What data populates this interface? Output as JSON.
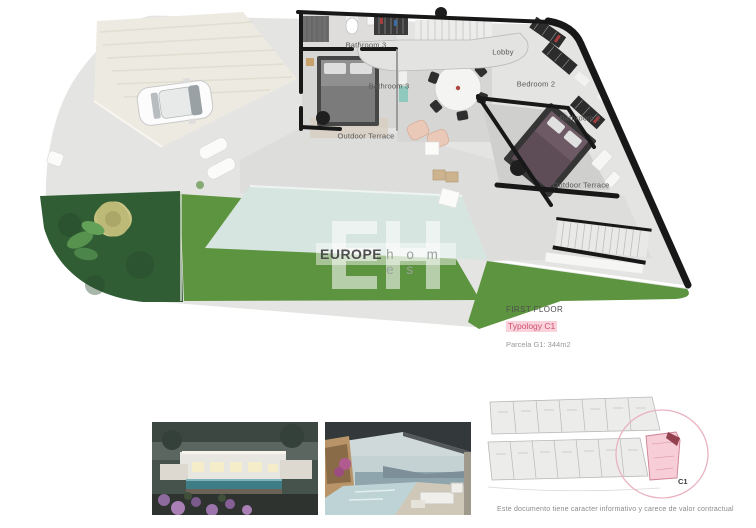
{
  "floorplan": {
    "labels": {
      "bathroom3_top": "Bathroom 3",
      "bathroom3_side": "Bathroom 3",
      "lobby": "Lobby",
      "bedroom2": "Bedroom 2",
      "bathroom2": "Bathroom 2",
      "outdoor_terrace_left": "Outdoor Terrace",
      "outdoor_terrace_right": "Outdoor Terrace"
    }
  },
  "logo": {
    "monogram": "EH",
    "primary": "EUROPE",
    "secondary": "h o m e s"
  },
  "title_block": {
    "floor": "FIRST FLOOR",
    "typology": "Typology C1",
    "parcel": "Parcela G1: 344m2"
  },
  "site_plan": {
    "unit_label": "C1"
  },
  "footer": {
    "disclaimer": "Este documento tiene caracter informativo y carece de valor contractual"
  },
  "colors": {
    "accent_pink": "#f7cdd7",
    "accent_red": "#d1506c",
    "lawn_green": "#5d9440",
    "garden_dark_green": "#315d35",
    "pool_blue": "#d7e5e1",
    "wall_black": "#181818"
  }
}
